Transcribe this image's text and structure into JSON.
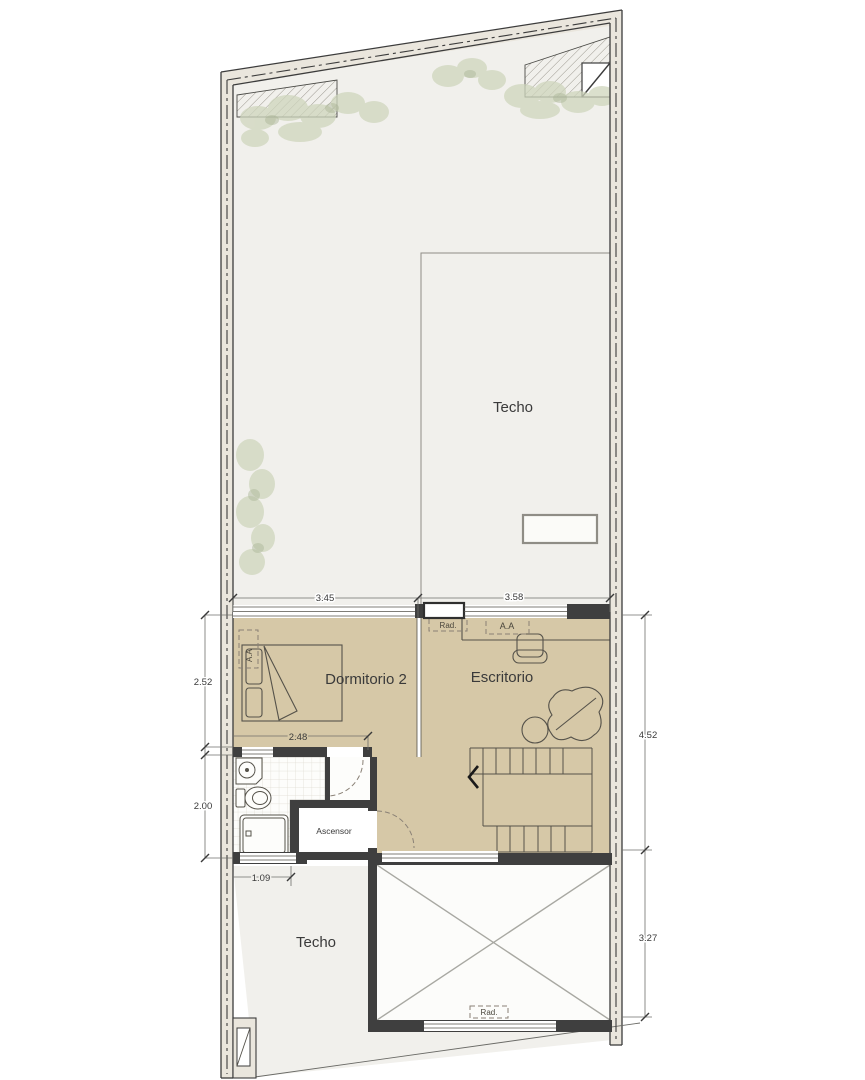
{
  "drawing": {
    "labels": {
      "techo_top": "Techo",
      "techo_bottom": "Techo",
      "dormitorio": "Dormitorio 2",
      "escritorio": "Escritorio",
      "ascensor": "Ascensor"
    },
    "equipment": {
      "rad_top": "Rad.",
      "rad_bottom": "Rad.",
      "aa_escritorio": "A.A",
      "aa_dormitorio": "A.A"
    },
    "dimensions": {
      "top_left_width": "3.45",
      "top_right_width": "3.58",
      "dormitorio_height": "2.52",
      "bed_wall_width": "2.48",
      "bath_height": "2.00",
      "bottom_left_width": "1.09",
      "right_upper_height": "4.52",
      "right_lower_height": "3.27"
    },
    "colors": {
      "room_floor": "#d6c8a7",
      "terrace": "#f1f0ec",
      "wall_fill": "#eae6dd",
      "wall_dark": "#3f3f3f",
      "greenery": "#cfd6bd",
      "dim_line": "#6f6f6b"
    }
  }
}
